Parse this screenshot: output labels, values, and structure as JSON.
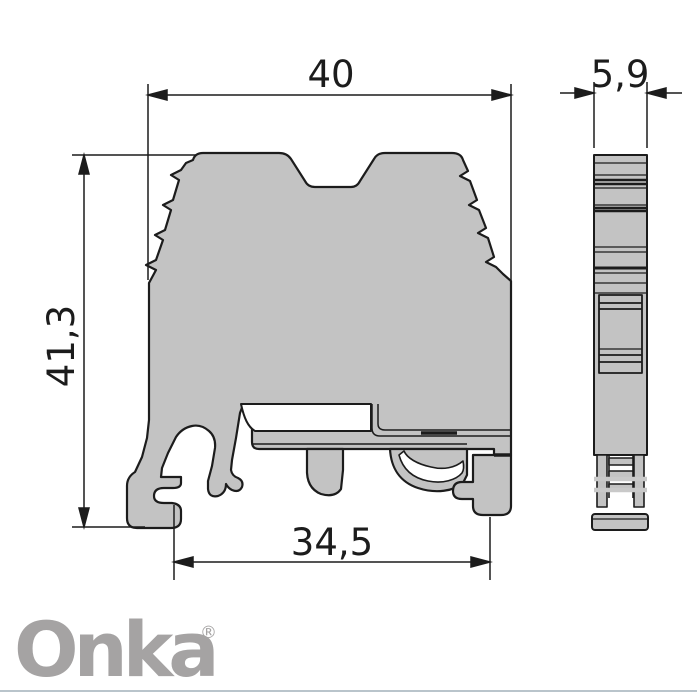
{
  "drawing": {
    "dimensions": {
      "top_width": "40",
      "side_width": "5,9",
      "height": "41,3",
      "bottom_width": "34,5"
    },
    "logo": {
      "text": "Onka",
      "registered_mark": "®"
    },
    "colors": {
      "body_fill": "#c3c3c3",
      "outline": "#1c1c1c",
      "logo_gray": "#a5a3a3",
      "footer_divider": "#b9c4cb"
    }
  }
}
